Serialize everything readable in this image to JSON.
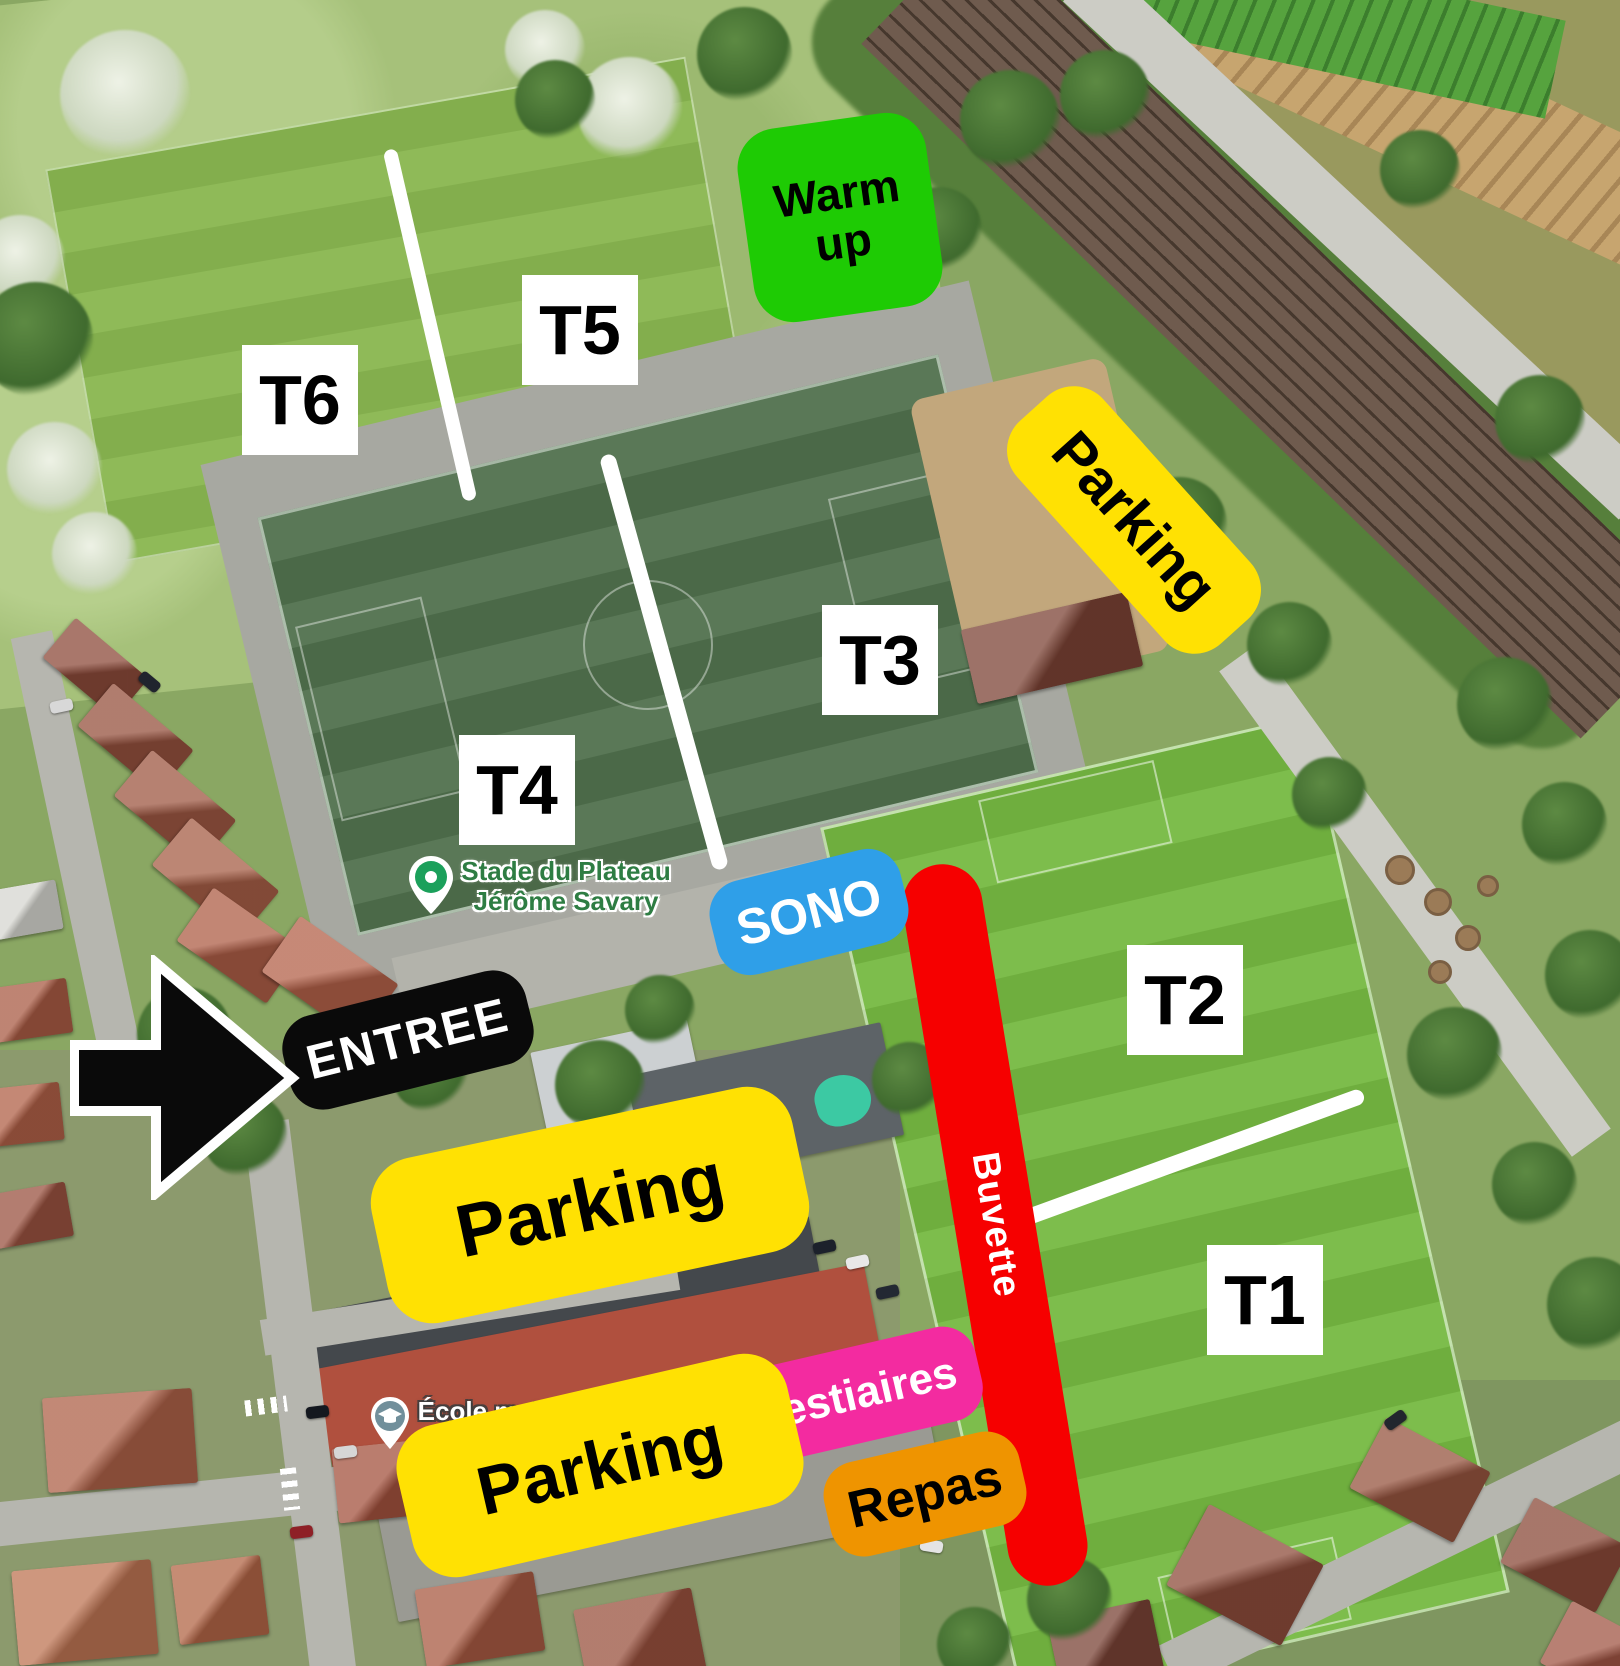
{
  "map_overlay": {
    "fields": {
      "t1": "T1",
      "t2": "T2",
      "t3": "T3",
      "t4": "T4",
      "t5": "T5",
      "t6": "T6"
    },
    "zones": {
      "warmup": "Warm up",
      "parking_rail": "Parking",
      "sono": "SONO",
      "entree": "ENTREE",
      "buvette": "Buvette",
      "parking_main": "Parking",
      "vestiaires": "Vestiaires",
      "repas": "Repas",
      "parking_south": "Parking"
    }
  },
  "map_labels": {
    "venue": {
      "line1": "Stade du Plateau",
      "line2": "Jérôme Savary"
    },
    "school": {
      "line1": "École maternelle",
      "line2": "Les Coccinelles"
    }
  },
  "colors": {
    "parking": "#FFE103",
    "warmup": "#1ECB04",
    "sono": "#2F9FE8",
    "buvette": "#F60000",
    "vestiaires": "#F32BA0",
    "repas": "#EF9400",
    "entree": "#0A0A0A",
    "zone_text_dark": "#000000",
    "zone_text_light": "#FFFFFF",
    "field_label_bg": "#FFFFFF",
    "field_label_text": "#000000",
    "divider": "#FFFFFF",
    "venue_text": "#2E7D43",
    "school_text": "#FFFFFF",
    "pin_green": "#1BA05B",
    "school_icon_bg": "#718F9B"
  }
}
